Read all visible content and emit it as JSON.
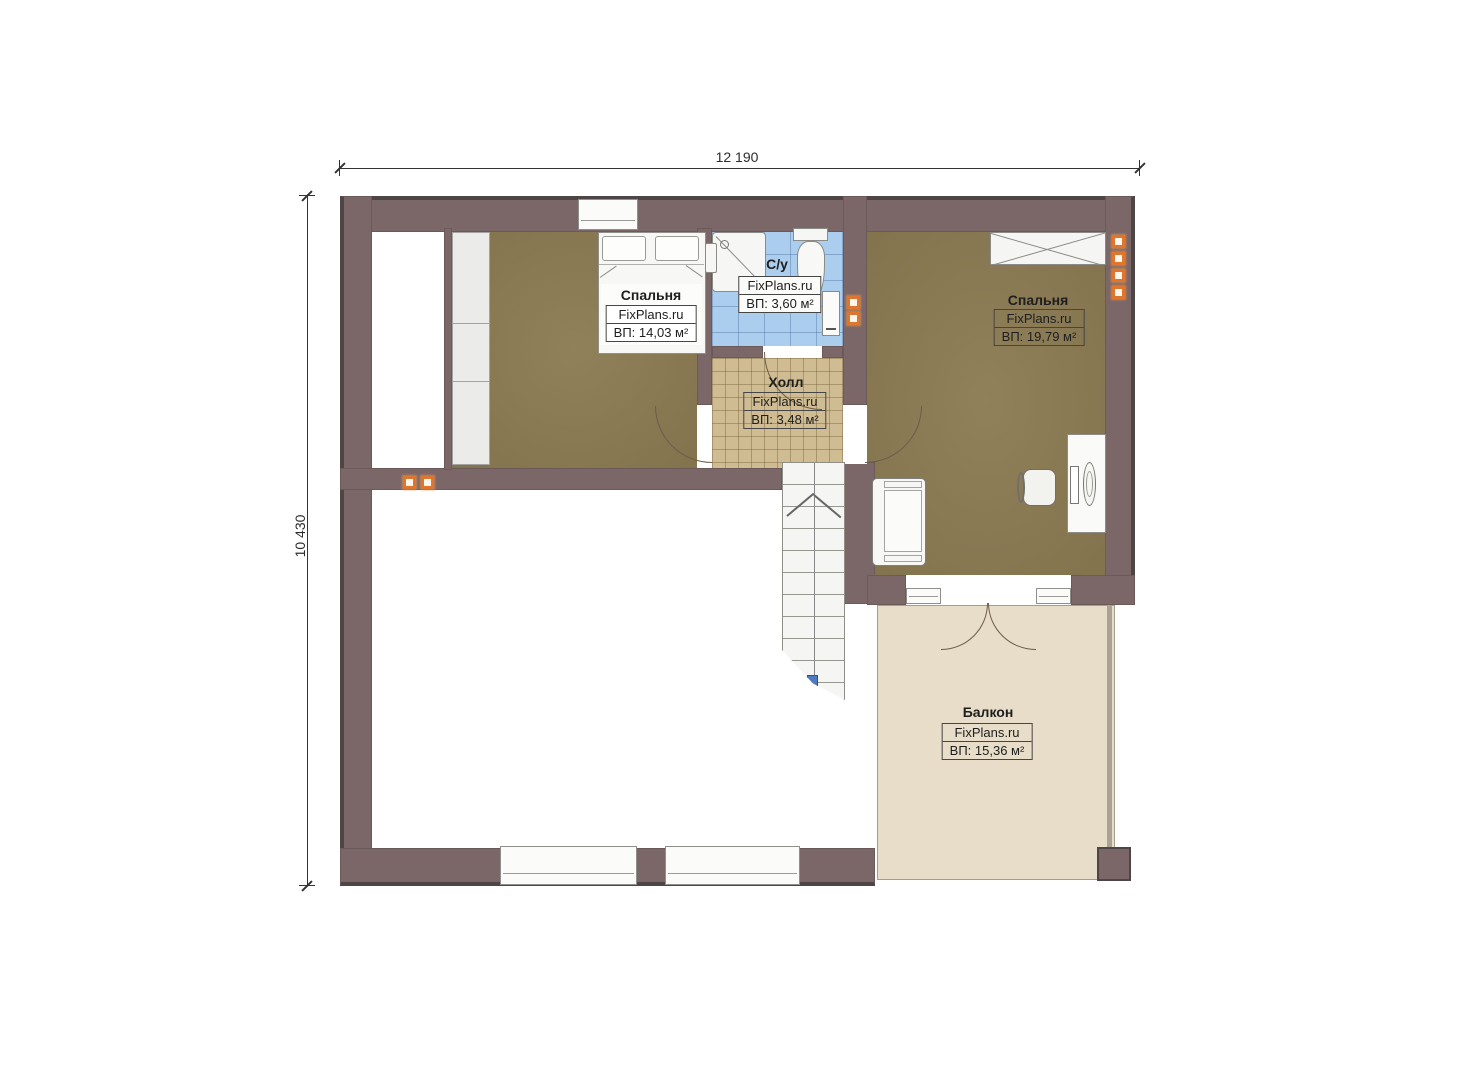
{
  "watermark": "FixPlans.ru",
  "dimensions": {
    "width_label": "12 190",
    "height_label": "10 430"
  },
  "rooms": [
    {
      "name": "Спальня",
      "brand": "FixPlans.ru",
      "area": "ВП: 14,03 м²"
    },
    {
      "name": "С/у",
      "brand": "FixPlans.ru",
      "area": "ВП: 3,60 м²"
    },
    {
      "name": "Холл",
      "brand": "FixPlans.ru",
      "area": "ВП: 3,48 м²"
    },
    {
      "name": "Спальня",
      "brand": "FixPlans.ru",
      "area": "ВП: 19,79 м²"
    },
    {
      "name": "Балкон",
      "brand": "FixPlans.ru",
      "area": "ВП: 15,36 м²"
    }
  ],
  "colors": {
    "wall": "#7b6768",
    "wall_edge": "#4e4546",
    "floor_wood": "#8b7a52",
    "floor_hall": "#cfbc92",
    "floor_bath": "#abceee",
    "floor_balcony": "#e7ddc8",
    "marker_orange": "#e0762e",
    "marker_blue": "#4d7ac2"
  }
}
